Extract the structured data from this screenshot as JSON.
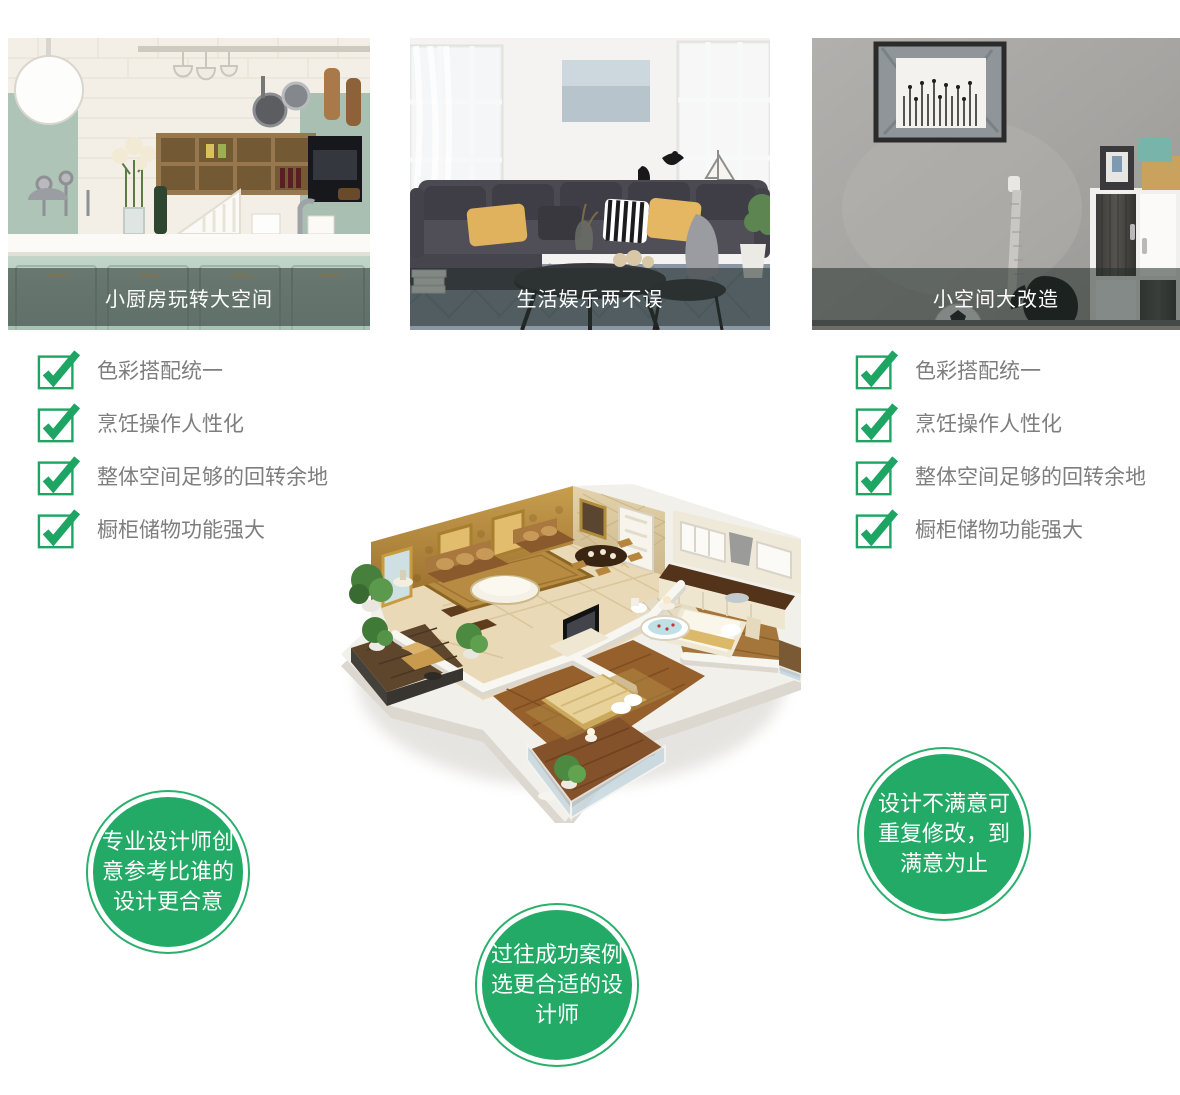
{
  "cards": [
    {
      "caption": "小厨房玩转大空间",
      "image_name": "kitchen-showcase-photo"
    },
    {
      "caption": "生活娱乐两不误",
      "image_name": "living-room-showcase-photo"
    },
    {
      "caption": "小空间大改造",
      "image_name": "small-space-showcase-photo"
    }
  ],
  "checklists": {
    "left": {
      "items": [
        "色彩搭配统一",
        "烹饪操作人性化",
        "整体空间足够的回转余地",
        "橱柜储物功能强大"
      ]
    },
    "right": {
      "items": [
        "色彩搭配统一",
        "烹饪操作人性化",
        "整体空间足够的回转余地",
        "橱柜储物功能强大"
      ]
    }
  },
  "badges": [
    {
      "lines": [
        "专业设计师创",
        "意参考比谁的",
        "设计更合意"
      ]
    },
    {
      "lines": [
        "过往成功案例",
        "选更合适的设",
        "计师"
      ]
    },
    {
      "lines": [
        "设计不满意可",
        "重复修改，到",
        "满意为止"
      ]
    }
  ],
  "colors": {
    "check_green": "#1fa563",
    "badge_green": "#23aa66",
    "badge_ring": "#2ab06c",
    "text_gray": "#7e7e7e",
    "caption_bg": "rgba(35,45,42,0.55)",
    "caption_text": "#ffffff"
  }
}
